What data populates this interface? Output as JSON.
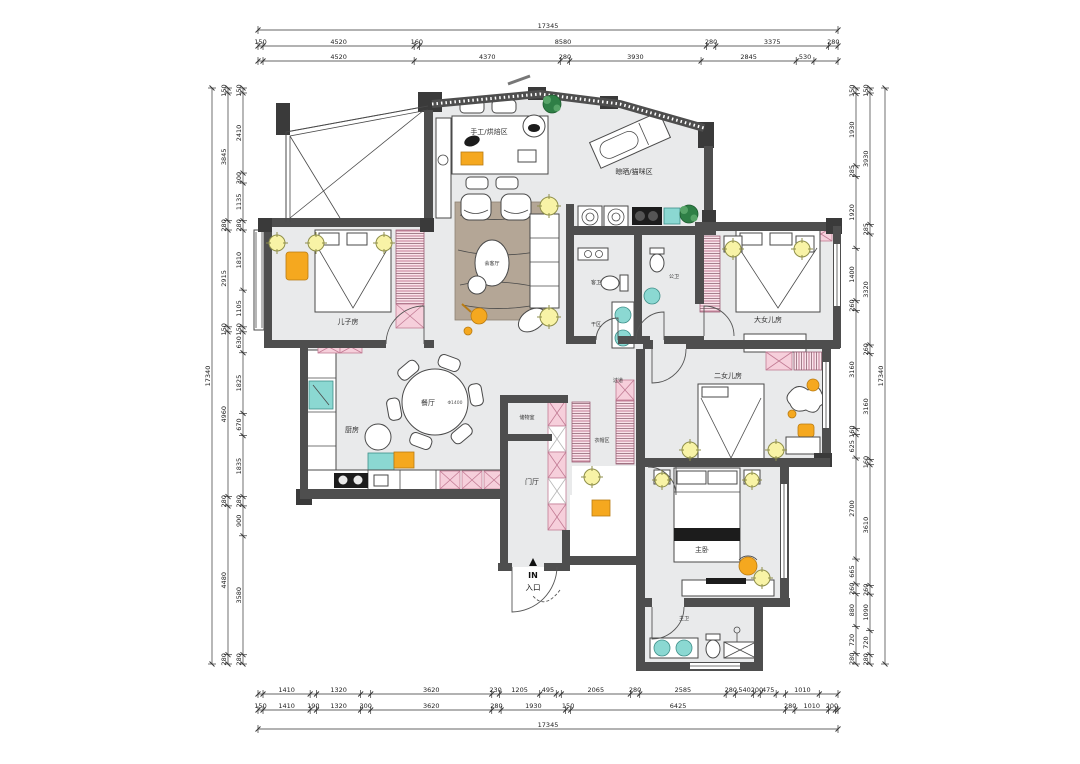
{
  "colors": {
    "wall": "#4e4e4e",
    "wall_dark": "#3a3a3a",
    "floor": "#e9eaeb",
    "pink": "#f6cfdb",
    "pink_line": "#c27b94",
    "orange": "#f5a81f",
    "teal": "#8bd8d2",
    "light_fill": "#f8f3a6",
    "light_stroke": "#8f8f4a",
    "green": "#2f7f46",
    "rug": "#b4a696",
    "dim_text": "#222222"
  },
  "plan": {
    "rooms": {
      "son": {
        "label": "儿子房"
      },
      "craft": {
        "label": "手工/烘焙区"
      },
      "reception": {
        "label": "会客厅"
      },
      "laundry_cat": {
        "label": "晾晒/猫咪区"
      },
      "daughter1": {
        "label": "大女儿房"
      },
      "daughter2": {
        "label": "二女儿房"
      },
      "master": {
        "label": "主卧"
      },
      "master_bath": {
        "label": "主卫"
      },
      "guest_bath": {
        "label": "客卫"
      },
      "public_bath": {
        "label": "公卫"
      },
      "dry_area": {
        "label": "干区"
      },
      "dining": {
        "label": "餐厅"
      },
      "dining_dia": {
        "label": "Φ1400"
      },
      "kitchen": {
        "label": "厨房"
      },
      "foyer": {
        "label": "门厅"
      },
      "storage": {
        "label": "储物室"
      },
      "cloak": {
        "label": "衣帽区"
      },
      "corridor": {
        "label": "过道"
      },
      "entry_in": {
        "label": "IN"
      },
      "entry": {
        "label": "入口"
      }
    },
    "dimensions": {
      "top": {
        "total": "17345",
        "row1": [
          {
            "v": "150"
          },
          {
            "v": "4520"
          },
          {
            "v": "160"
          },
          {
            "v": "8580"
          },
          {
            "v": "280"
          },
          {
            "v": "3375"
          },
          {
            "v": "280"
          }
        ],
        "row2": [
          {
            "v": "150",
            "blank": true
          },
          {
            "v": "4520"
          },
          {
            "v": "4370"
          },
          {
            "v": "280"
          },
          {
            "v": "3930"
          },
          {
            "v": "2845"
          },
          {
            "v": "530"
          },
          {
            "v": "720",
            "blank": true
          }
        ]
      },
      "bottom": {
        "total": "17345",
        "row1": [
          {
            "v": "150",
            "blank": true
          },
          {
            "v": "1410"
          },
          {
            "v": "190",
            "blank": true
          },
          {
            "v": "1320"
          },
          {
            "v": "300",
            "blank": true
          },
          {
            "v": "3620"
          },
          {
            "v": "230"
          },
          {
            "v": "1205"
          },
          {
            "v": "495"
          },
          {
            "v": "150",
            "blank": true
          },
          {
            "v": "2065"
          },
          {
            "v": "280"
          },
          {
            "v": "2585"
          },
          {
            "v": "280"
          },
          {
            "v": "540"
          },
          {
            "v": "200"
          },
          {
            "v": "475"
          },
          {
            "v": "280",
            "blank": true
          },
          {
            "v": "1010"
          },
          {
            "v": "560",
            "blank": true
          }
        ],
        "row2": [
          {
            "v": "150"
          },
          {
            "v": "1410"
          },
          {
            "v": "190"
          },
          {
            "v": "1320"
          },
          {
            "v": "300"
          },
          {
            "v": "3620"
          },
          {
            "v": "280"
          },
          {
            "v": "1930"
          },
          {
            "v": "150"
          },
          {
            "v": "6425"
          },
          {
            "v": "280"
          },
          {
            "v": "1010"
          },
          {
            "v": "200"
          },
          {
            "v": "80",
            "blank": true
          }
        ]
      },
      "left": {
        "total": "17340",
        "outer": [
          {
            "v": "150"
          },
          {
            "v": "3845"
          },
          {
            "v": "280"
          },
          {
            "v": "2915"
          },
          {
            "v": "150"
          },
          {
            "v": "4960"
          },
          {
            "v": "280"
          },
          {
            "v": "4480"
          },
          {
            "v": "280"
          }
        ],
        "inner": [
          {
            "v": "150"
          },
          {
            "v": "2410"
          },
          {
            "v": "300"
          },
          {
            "v": "1135"
          },
          {
            "v": "280"
          },
          {
            "v": "1810"
          },
          {
            "v": "1105"
          },
          {
            "v": "150"
          },
          {
            "v": "630"
          },
          {
            "v": "1825"
          },
          {
            "v": "670"
          },
          {
            "v": "1835"
          },
          {
            "v": "280"
          },
          {
            "v": "900"
          },
          {
            "v": "3580"
          },
          {
            "v": "280"
          }
        ]
      },
      "right": {
        "total": "17340",
        "inner": [
          {
            "v": "150"
          },
          {
            "v": "1930"
          },
          {
            "v": "285"
          },
          {
            "v": "1920"
          },
          {
            "v": "1400"
          },
          {
            "v": "260"
          },
          {
            "v": "3160"
          },
          {
            "v": "160"
          },
          {
            "v": "625"
          },
          {
            "v": "2700"
          },
          {
            "v": "665"
          },
          {
            "v": "260"
          },
          {
            "v": "880"
          },
          {
            "v": "720"
          },
          {
            "v": "280"
          }
        ],
        "outer": [
          {
            "v": "150"
          },
          {
            "v": "3930"
          },
          {
            "v": "285"
          },
          {
            "v": "3320"
          },
          {
            "v": "260"
          },
          {
            "v": "3160"
          },
          {
            "v": "160"
          },
          {
            "v": "3610"
          },
          {
            "v": "260"
          },
          {
            "v": "1090"
          },
          {
            "v": "720"
          },
          {
            "v": "280"
          }
        ]
      }
    }
  }
}
